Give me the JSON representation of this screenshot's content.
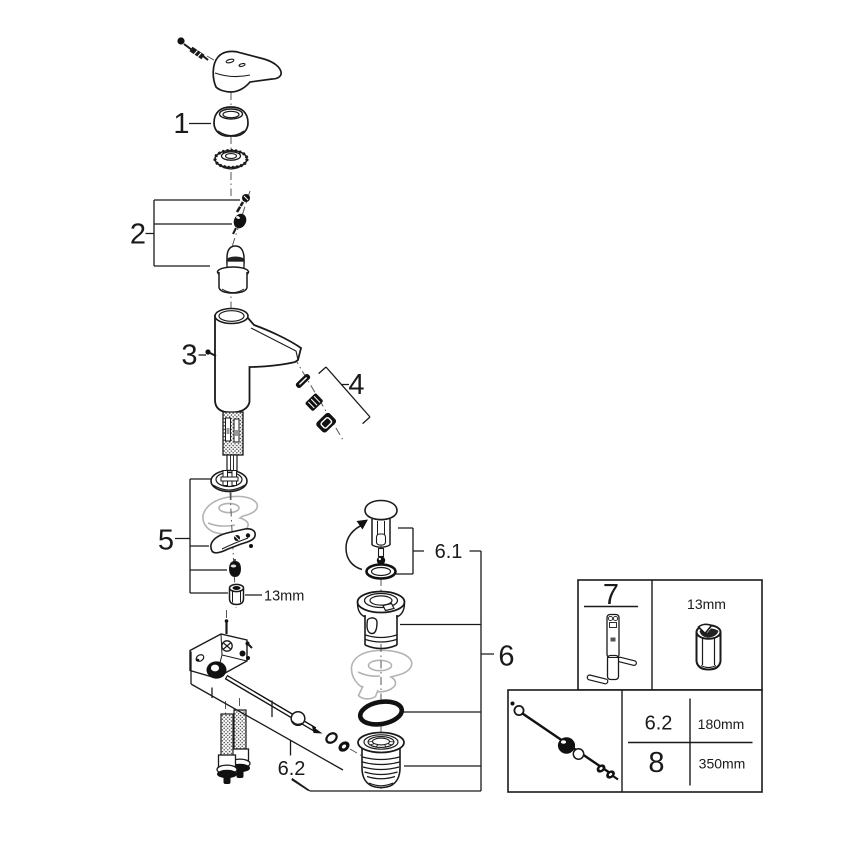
{
  "colors": {
    "line": "#1a1a1a",
    "ghost": "#b3b3b3",
    "background": "#ffffff"
  },
  "callouts": {
    "n1": "1",
    "n2": "2",
    "n3": "3",
    "n4": "4",
    "n5": "5",
    "n6": "6",
    "n6_1": "6.1",
    "n6_2": "6.2"
  },
  "inline_note": {
    "socket_size": "13mm"
  },
  "tool_box": {
    "tool_ref": "7",
    "socket_size": "13mm"
  },
  "rod_box": {
    "rows": [
      {
        "ref": "6.2",
        "length": "180mm"
      },
      {
        "ref": "8",
        "length": "350mm"
      }
    ]
  }
}
